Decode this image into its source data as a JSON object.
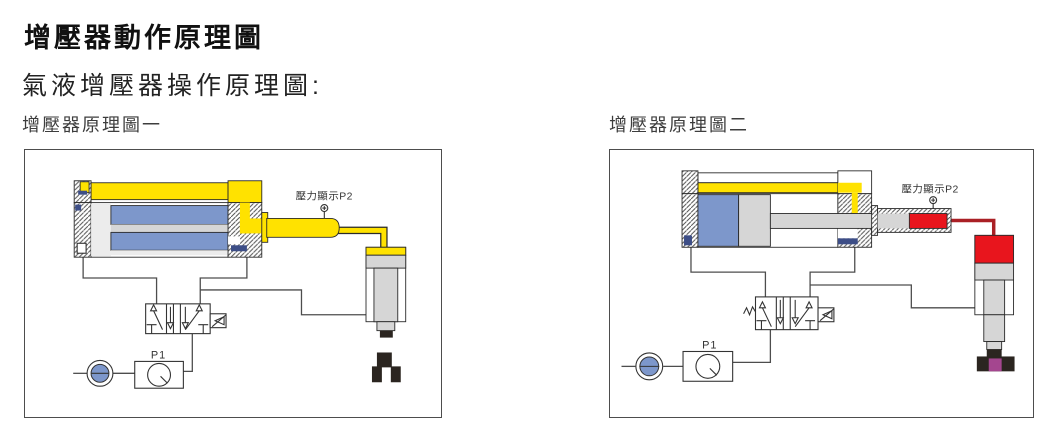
{
  "header": {
    "title": "增壓器動作原理圖",
    "subtitle": "氣液增壓器操作原理圖:"
  },
  "diagrams": [
    {
      "caption": "增壓器原理圖一",
      "gauge_label": "壓力顯示P2",
      "regulator_label": "P1",
      "state": "booster-retracted"
    },
    {
      "caption": "增壓器原理圖二",
      "gauge_label": "壓力顯示P2",
      "regulator_label": "P1",
      "state": "booster-extended-clamping"
    }
  ],
  "colors": {
    "yellow": "#ffe200",
    "blue": "#7d97cb",
    "red": "#e8151d",
    "dark_red": "#aa2025",
    "purple": "#a4468f",
    "gray": "#d6d6d6",
    "light_gray": "#ececec",
    "navy": "#3d4e87",
    "dark": "#2b2520",
    "line": "#4d4d4d",
    "ink": "#2a2a2a"
  }
}
